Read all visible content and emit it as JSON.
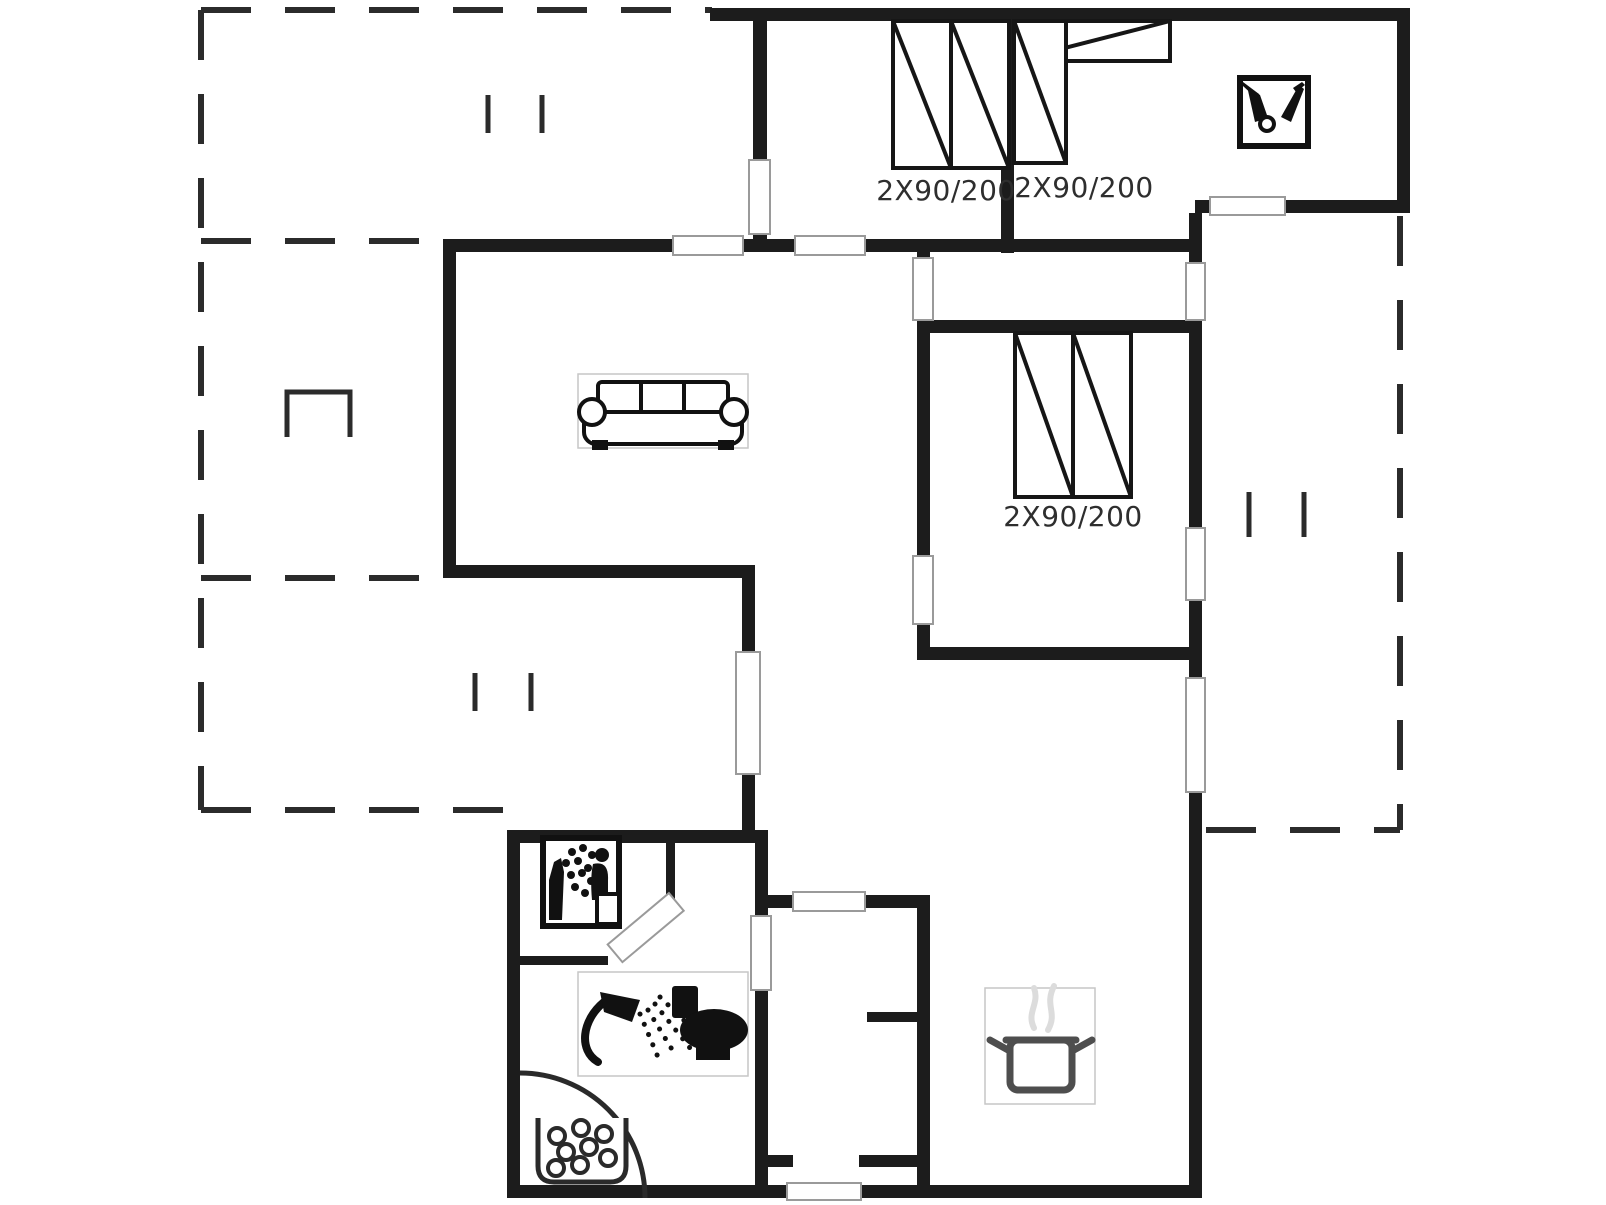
{
  "page": {
    "background": "#ffffff",
    "type": "floor-plan"
  },
  "colors": {
    "wall": "#1c1c1c",
    "dash": "#2b2b2b",
    "opening_stroke": "#9a9a9a",
    "icon": "#111111",
    "bed": "#161616",
    "label": "#2e2e2e",
    "box_border": "#c6c6c6",
    "pot_stroke": "#4e4e4e",
    "steam": "#dcdcdc",
    "fixture": "#2a2a2a"
  },
  "labels": {
    "bed_double_top_left": "2X90/200",
    "bed_corner_top_right": "2X90/200",
    "bed_double_middle": "2X90/200"
  },
  "icons": [
    {
      "name": "garden-tools-icon",
      "location": "top-right-room"
    },
    {
      "name": "double-bed-icon",
      "label": "2X90/200",
      "location": "bedroom-top-left"
    },
    {
      "name": "corner-bed-icon",
      "label": "2X90/200",
      "location": "bedroom-top-right"
    },
    {
      "name": "double-bed-icon",
      "label": "2X90/200",
      "location": "bedroom-middle"
    },
    {
      "name": "sofa-icon",
      "location": "living-room"
    },
    {
      "name": "sauna-icon",
      "location": "bathroom"
    },
    {
      "name": "shower-icon",
      "location": "bathroom"
    },
    {
      "name": "toilet-icon",
      "location": "bathroom"
    },
    {
      "name": "whirlpool-icon",
      "location": "bathroom"
    },
    {
      "name": "shower-cabin-arc",
      "location": "bathroom"
    },
    {
      "name": "cooking-pot-icon",
      "location": "kitchen"
    },
    {
      "name": "grill-icon",
      "location": "left-terrace"
    },
    {
      "name": "decking-tick-marks",
      "location": "terraces"
    }
  ]
}
